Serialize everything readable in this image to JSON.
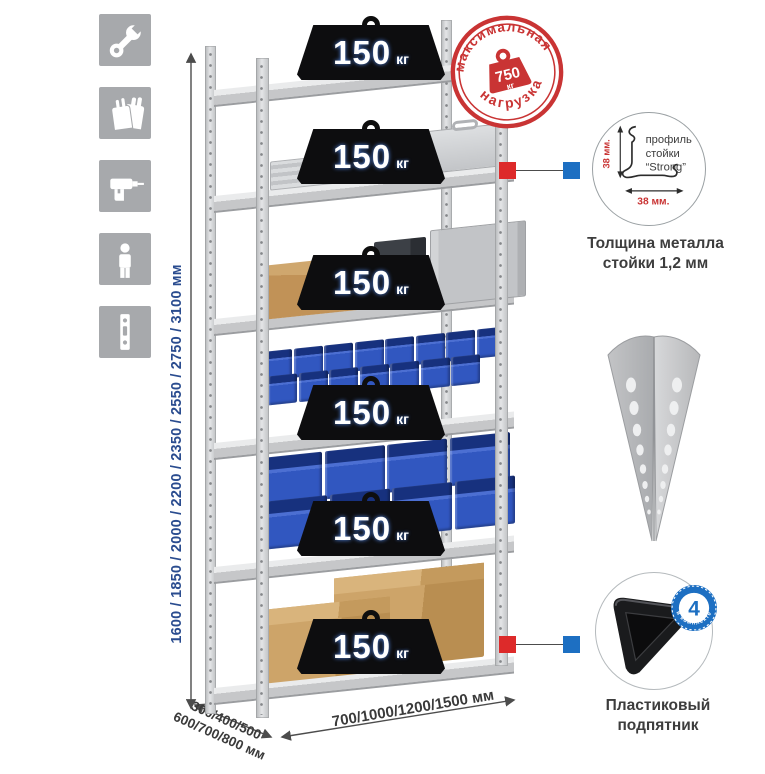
{
  "page": {
    "background": "#ffffff"
  },
  "left_icons": [
    {
      "name": "wrench"
    },
    {
      "name": "gloves"
    },
    {
      "name": "drill"
    },
    {
      "name": "person"
    },
    {
      "name": "upright-profile"
    }
  ],
  "dimensions": {
    "height": "1600 / 1850 / 2000 / 2200 / 2350 / 2550 / 2750 / 3100 мм",
    "depth_line1": "300/400/500",
    "depth_line2": "600/700/800 мм",
    "width": "700/1000/1200/1500 мм"
  },
  "max_load_stamp": {
    "arc_top": "максимальная",
    "arc_bottom": "нагрузка",
    "value": "750",
    "unit": "кг"
  },
  "rack": {
    "shelves": [
      {
        "load": "150",
        "unit": "кг",
        "content": {
          "type": "empty"
        }
      },
      {
        "load": "150",
        "unit": "кг",
        "content": {
          "type": "aluminum-cases"
        }
      },
      {
        "load": "150",
        "unit": "кг",
        "content": {
          "type": "mixed-boxes"
        }
      },
      {
        "load": "150",
        "unit": "кг",
        "content": {
          "type": "small-bins",
          "rows": [
            8,
            7
          ]
        }
      },
      {
        "load": "150",
        "unit": "кг",
        "content": {
          "type": "large-bins",
          "rows": [
            4,
            4
          ]
        }
      },
      {
        "load": "150",
        "unit": "кг",
        "content": {
          "type": "cardboard-boxes"
        }
      }
    ]
  },
  "profile_detail": {
    "label_line1": "профиль",
    "label_line2": "стойки",
    "label_line3": "“Strong”",
    "dim_vertical": "38 мм.",
    "dim_horizontal": "38 мм.",
    "caption_line1": "Толщина металла",
    "caption_line2": "стойки 1,2 мм"
  },
  "foot_detail": {
    "badge_value": "4",
    "badge_arc": "в комплекте",
    "caption_line1": "Пластиковый",
    "caption_line2": "подпятник"
  },
  "colors": {
    "accent_red": "#cf3434",
    "accent_blue": "#1d6fc2",
    "dimension_blue": "#2a4c8f",
    "metal_gray": "#c7c8ca",
    "bin_blue": "#3157c0",
    "cardboard": "#c59a63",
    "badge_black": "#0d0d0f"
  }
}
